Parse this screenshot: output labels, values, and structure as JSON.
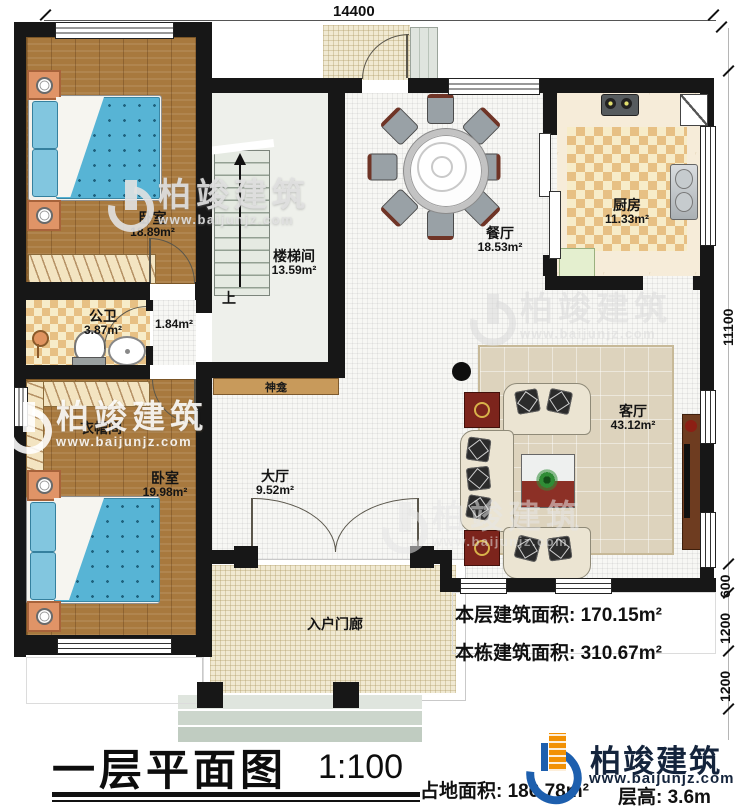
{
  "meta": {
    "plan_title": "一层平面图",
    "scale": "1:100"
  },
  "title_block": {
    "site_area": "占地面积: 186.78m²",
    "floor_height": "层高: 3.6m"
  },
  "notes": {
    "floor_area": "本层建筑面积: 170.15m²",
    "building_area": "本栋建筑面积: 310.67m²"
  },
  "dims": {
    "top": "14400",
    "right": "11100",
    "r600": "600",
    "r1200a": "1200",
    "r1200b": "1200"
  },
  "rooms": {
    "bedroom1": {
      "name": "卧室",
      "area": "18.89m²"
    },
    "stair": {
      "name": "楼梯间",
      "area": "13.59m²"
    },
    "dining": {
      "name": "餐厅",
      "area": "18.53m²"
    },
    "kitchen": {
      "name": "厨房",
      "area": "11.33m²"
    },
    "bath": {
      "name": "公卫",
      "area": "3.87m²"
    },
    "corridor": {
      "area": "1.84m²"
    },
    "cloak": {
      "name": "衣帽间"
    },
    "bedroom2": {
      "name": "卧室",
      "area": "19.98m²"
    },
    "hall": {
      "name": "大厅",
      "area": "9.52m²"
    },
    "living": {
      "name": "客厅",
      "area": "43.12m²"
    },
    "porch": {
      "name": "入户门廊"
    },
    "shrine": {
      "name": "神龛"
    },
    "stairs_up": "上"
  },
  "brand": {
    "name": "柏竣建筑",
    "url": "www.baijunjz.com"
  },
  "watermark": {
    "name": "柏竣建筑",
    "url": "www.baijunjz.com"
  },
  "colors": {
    "wall": "#171717",
    "wood_floor": "#a8793e",
    "bed_blue": "#57b4d5",
    "checker_tan": "#e7c084",
    "porch_floor": "#f0e9d2",
    "brand_blue": "#1d5fae",
    "brand_orange": "#f29104",
    "brand_navy": "#14243c"
  }
}
